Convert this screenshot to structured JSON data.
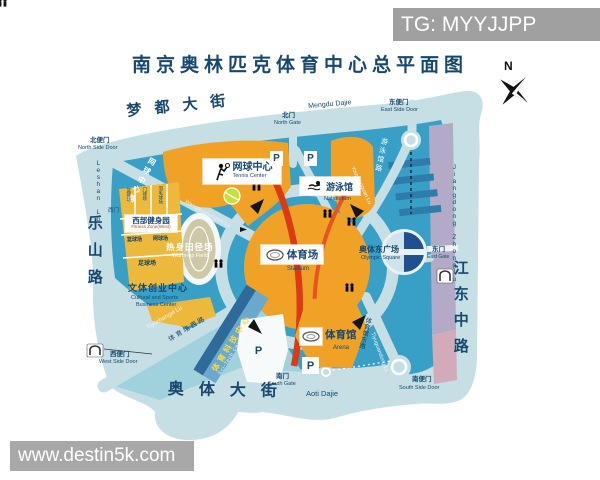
{
  "header": {
    "watermark": "TG: MYYJJPP",
    "title": "南京奥林匹克体育中心总平面图",
    "compass": "N"
  },
  "footer": {
    "watermark": "www.destin5k.com"
  },
  "streets": {
    "mengdu_cn": "梦都大街",
    "mengdu_en": "Mengdu Dajie",
    "leshan_cn": "乐山路",
    "leshan_en": "Leshan Lu",
    "jiangdong_cn": "江东中路",
    "jiangdong_en": "Jiangdong Zhonglu",
    "aoti_cn": "奥体大街",
    "aoti_en": "Aoti Dajie",
    "wangqiu_cn": "网球中心路",
    "wangqiu_en": "Wangqiuzhongxin Lu",
    "youyong_cn": "游泳馆路",
    "youyong_en": "Youyongguan Lu",
    "tiyuchangxi_cn": "体育场西路",
    "tiyuchangxi_en": "Tiyuchangxi Lu",
    "tiyuguandong_cn": "体育馆东路",
    "tiyuguandong_en": "Tiyuguandong Lu"
  },
  "gates": {
    "north_side_cn": "北便门",
    "north_side_en": "North Side Door",
    "north_cn": "北门",
    "north_en": "North Gate",
    "east_side_cn": "东便门",
    "east_side_en": "East Side Door",
    "east_cn": "东门",
    "east_en": "East Gate",
    "south_cn": "南门",
    "south_en": "South Gate",
    "south_side_cn": "南便门",
    "south_side_en": "South Side Door",
    "west_side_cn": "西便门",
    "west_side_en": "West Side Door",
    "west_cn": "西门"
  },
  "venues": {
    "tennis_cn": "网球中心",
    "tennis_en": "Tennis Center",
    "natatorium_cn": "游泳馆",
    "natatorium_en": "Natatorium",
    "stadium_cn": "体育场",
    "stadium_en": "Stadium",
    "warmup_cn": "热身田径场",
    "warmup_en": "Warm-up Field",
    "fitness_cn": "西部健身园",
    "fitness_en": "Fitness Zone(West)",
    "business_cn": "文体创业中心",
    "business_en1": "Cultural and Sports",
    "business_en2": "Business Center",
    "scitech_cn": "体育科技中心",
    "scitech_en": "Sci-Tech Center",
    "arena_cn": "体育馆",
    "arena_en": "Arena",
    "square_cn": "奥体东广场",
    "square_en": "Olympic Square",
    "court_strip1": "篮球场",
    "court_strip2": "门球场",
    "court_strip3": "羽毛球场",
    "court_small1": "篮球场",
    "court_small2": "网球场",
    "court_football": "足球场",
    "parking": "P"
  },
  "colors": {
    "accent_orange": "#f0a227",
    "map_teal": "#38a0c6",
    "navy": "#17486e",
    "stadium_red": "#dc3a14"
  }
}
